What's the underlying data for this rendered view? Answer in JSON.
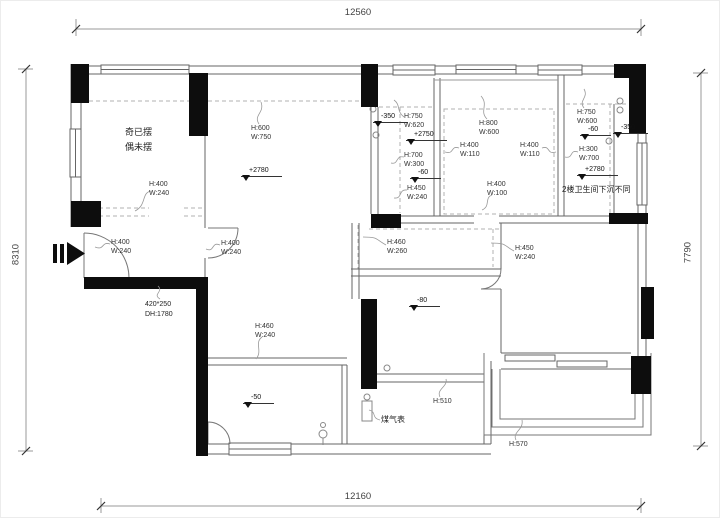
{
  "dimensions": {
    "top": "12560",
    "bottom": "12160",
    "left": "8310",
    "right": "7790"
  },
  "notes": {
    "room_line1": "奇已摆",
    "room_line2": "偶未摆",
    "entry_line1": "420*250",
    "entry_line2": "DH:1780",
    "gas_meter": "煤气表",
    "bath": "2楼卫生间下沉不同"
  },
  "annotations": [
    {
      "h": "H:400",
      "w": "W:240"
    },
    {
      "h": "H:600",
      "w": "W:750"
    },
    {
      "h": "H:400",
      "w": "W:240"
    },
    {
      "h": "H:400",
      "w": "W:240"
    },
    {
      "h": "H:750",
      "w": "W:620"
    },
    {
      "h": "H:700",
      "w": "W:300"
    },
    {
      "h": "H:450",
      "w": "W:240"
    },
    {
      "h": "H:800",
      "w": "W:600"
    },
    {
      "h": "H:400",
      "w": "W:110"
    },
    {
      "h": "H:400",
      "w": "W:110"
    },
    {
      "h": "H:400",
      "w": "W:100"
    },
    {
      "h": "H:750",
      "w": "W:600"
    },
    {
      "h": "H:300",
      "w": "W:700"
    },
    {
      "h": "H:460",
      "w": "W:260"
    },
    {
      "h": "H:450",
      "w": "W:240"
    },
    {
      "h": "H:460",
      "w": "W:240"
    },
    {
      "h": "H:510"
    },
    {
      "h": "H:570"
    }
  ],
  "elevations": [
    {
      "value": "+2780"
    },
    {
      "value": "-350"
    },
    {
      "value": "+2750"
    },
    {
      "value": "-60"
    },
    {
      "value": "-60"
    },
    {
      "value": "-350"
    },
    {
      "value": "+2780"
    },
    {
      "value": "-80"
    },
    {
      "value": "-50"
    }
  ]
}
